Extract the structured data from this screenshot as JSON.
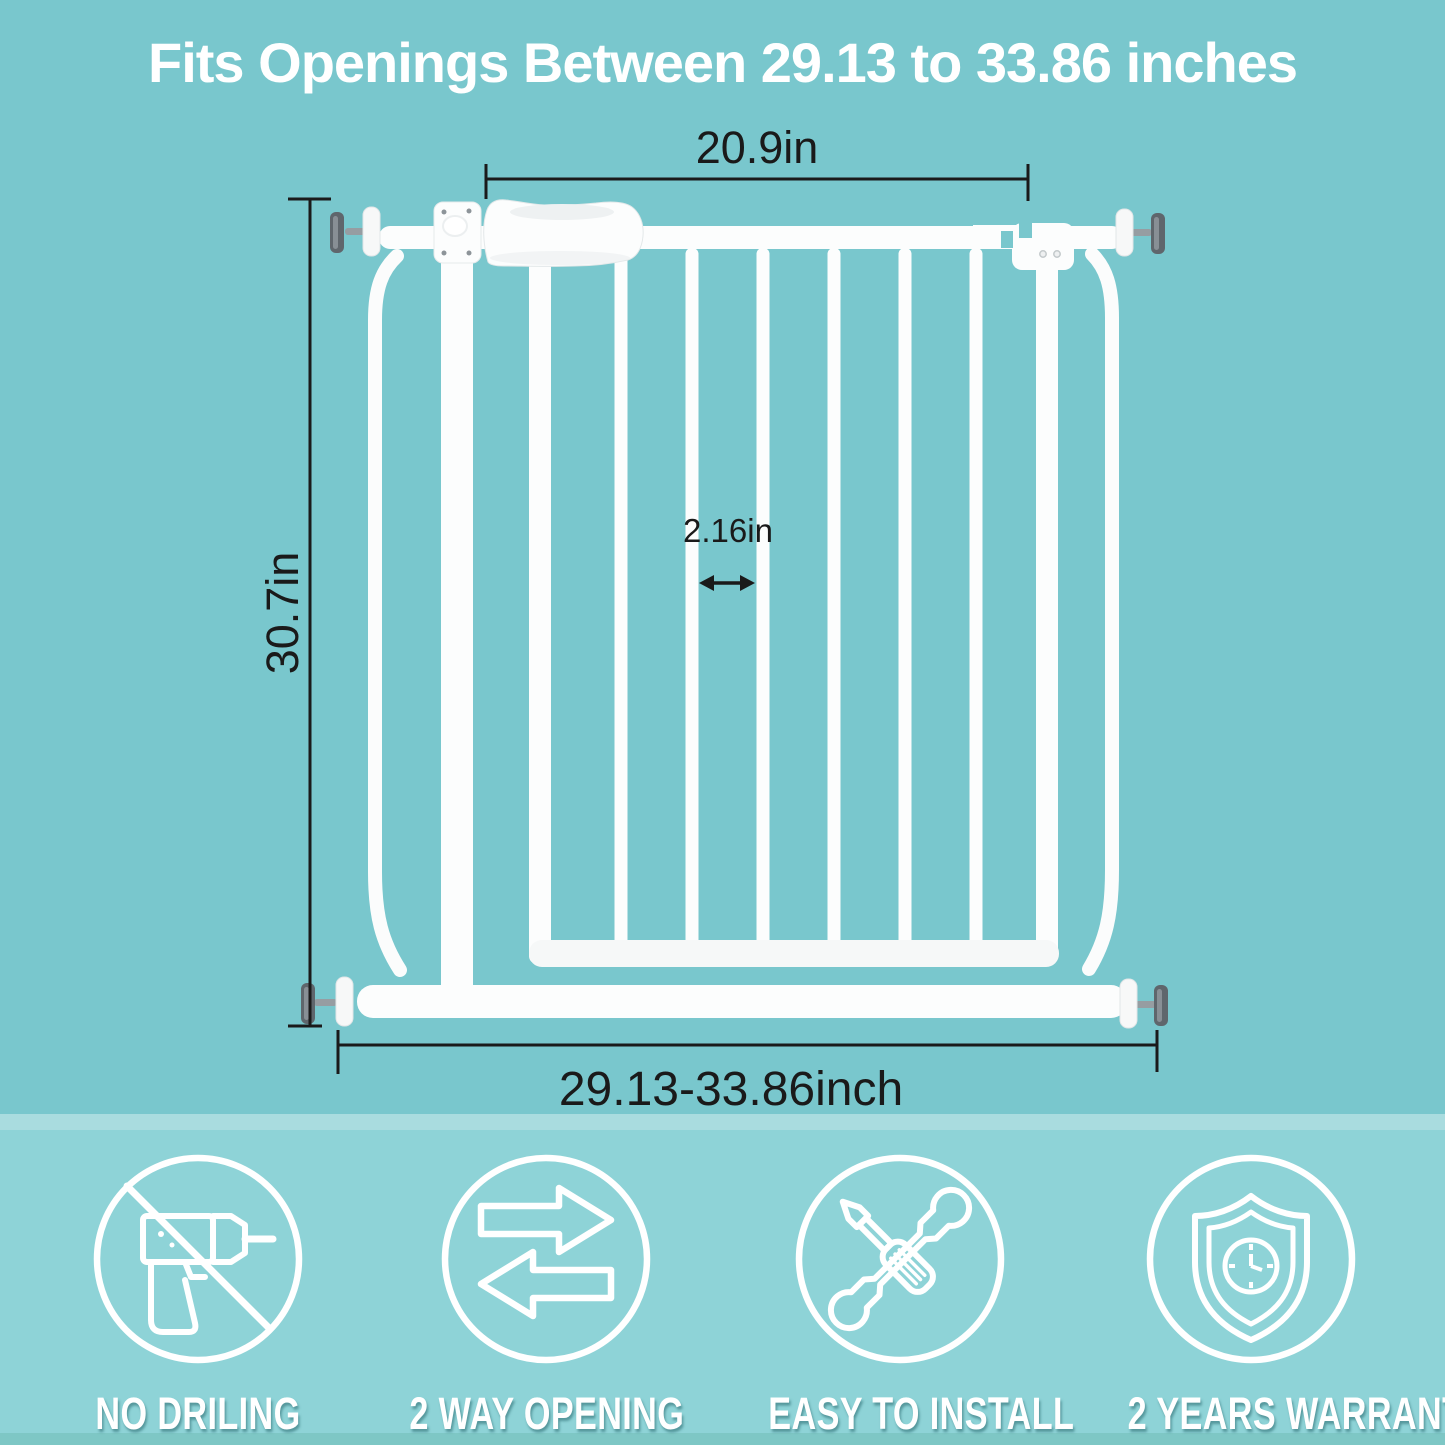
{
  "header": {
    "title": "Fits Openings Between 29.13 to 33.86 inches"
  },
  "dimensions": {
    "door_width": "20.9in",
    "height": "30.7in",
    "bar_gap": "2.16in",
    "opening_range": "29.13-33.86inch"
  },
  "features": [
    {
      "label": "NO DRILING",
      "icon": "no-drilling-icon"
    },
    {
      "label": "2 WAY OPENING",
      "icon": "two-way-opening-icon"
    },
    {
      "label": "EASY TO INSTALL",
      "icon": "easy-to-install-icon"
    },
    {
      "label": "2 YEARS WARRANTY",
      "icon": "two-years-warranty-icon"
    }
  ],
  "colors": {
    "background": "#79c7cd",
    "band": "#8ed3d7",
    "band_strip": "#a9dcdf",
    "band_bottom_edge": "#7ec7c5",
    "title_text": "#ffffff",
    "dimension_text": "#1a1a1a",
    "gate_white": "#fcfdfd",
    "icon_stroke": "#ffffff"
  }
}
